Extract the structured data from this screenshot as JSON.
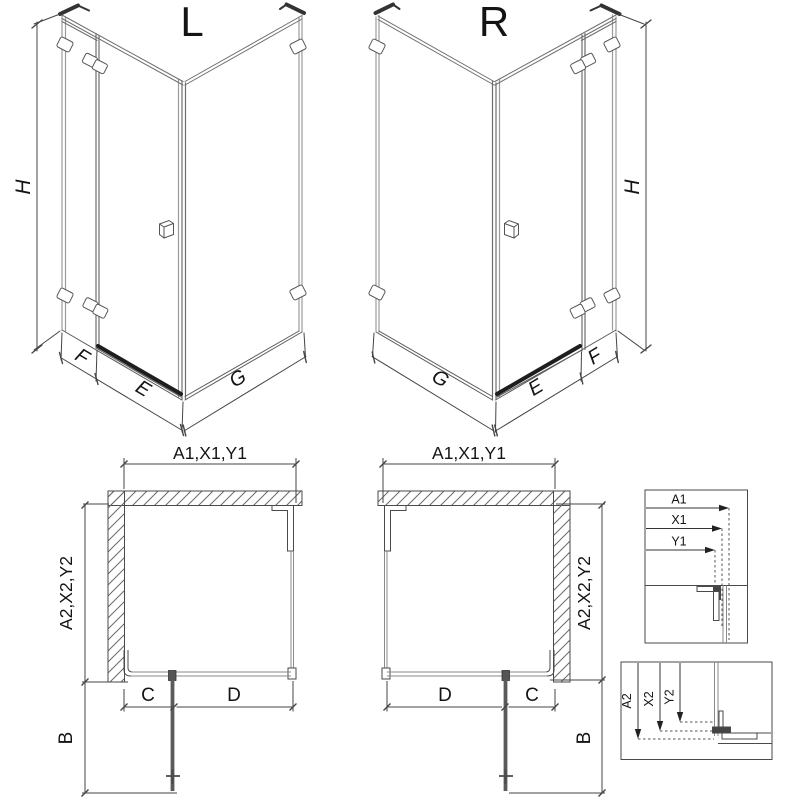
{
  "colors": {
    "line_dark": "#3c3c3c",
    "line_mid": "#6e6e6e",
    "glass_gray": "#9b9b9b",
    "threshold_black": "#1e1e1e",
    "background": "#ffffff"
  },
  "iso_left": {
    "view_label": "L",
    "dim_height": "H",
    "dim_fixed_width": "F",
    "dim_door_width": "E",
    "dim_side_width": "G"
  },
  "iso_right": {
    "view_label": "R",
    "dim_height": "H",
    "dim_fixed_width": "F",
    "dim_door_width": "E",
    "dim_side_width": "G"
  },
  "plan_left": {
    "dim_top": "A1,X1,Y1",
    "dim_side": "A2,X2,Y2",
    "dim_fixed": "C",
    "dim_door": "D",
    "dim_door_open": "B"
  },
  "plan_right": {
    "dim_top": "A1,X1,Y1",
    "dim_side": "A2,X2,Y2",
    "dim_fixed": "C",
    "dim_door": "D",
    "dim_door_open": "B"
  },
  "detail_top": {
    "rows": [
      "A1",
      "X1",
      "Y1"
    ]
  },
  "detail_bottom": {
    "rows": [
      "A2",
      "X2",
      "Y2"
    ]
  }
}
